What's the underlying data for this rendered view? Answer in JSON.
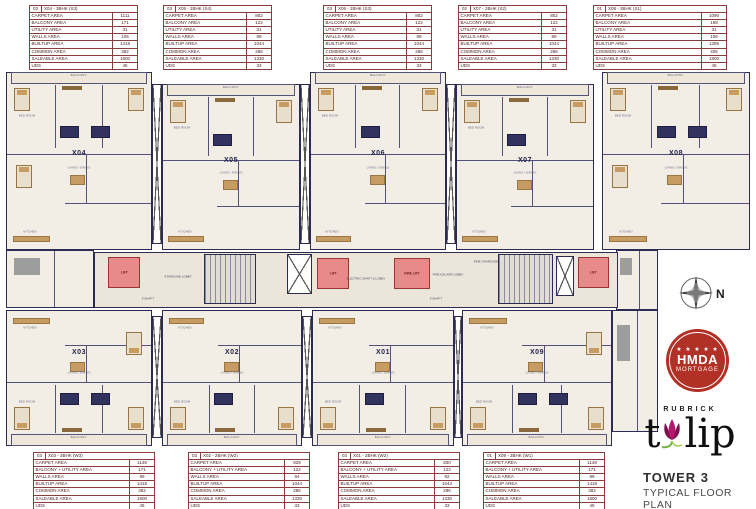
{
  "meta": {
    "tower_title": "TOWER 3",
    "subtitle": "TYPICAL FLOOR PLAN",
    "brand_top": "RUBRICK",
    "brand_word_left": "t",
    "brand_word_right": "lip",
    "badge_stars": "★ ★ ★ ★ ★",
    "badge_line1": "HMDA",
    "badge_line2": "MORTGAGE",
    "compass_n": "N"
  },
  "colors": {
    "wall": "#2c2c52",
    "cream": "#f2eee5",
    "corridor": "#ece6da",
    "tan": "#c69c62",
    "navy": "#32325e",
    "lift": "#e98a8a",
    "lift_border": "#9c3434",
    "table_border": "#8a3d3d",
    "table_text": "#4c2323"
  },
  "table_row_labels_top": [
    "CARPET AREA",
    "BALCONY AREA",
    "UTILITY AREA",
    "WALLS AREA",
    "BUILTUP AREA",
    "COMMON AREA",
    "SALEABLE AREA",
    "UDS"
  ],
  "table_row_labels_bottom": [
    "CARPET AREA",
    "BALCONY + UTILITY AREA",
    "WALLS AREA",
    "BUILTUP AREA",
    "COMMON AREA",
    "SALEABLE AREA",
    "UDS"
  ],
  "tables": {
    "top": [
      {
        "index": "03",
        "name": "X04 - 3BHK (S3)",
        "values": [
          "1111",
          "171",
          "31",
          "105",
          "1418",
          "382",
          "1800",
          "45"
        ],
        "x": 29,
        "w": 109
      },
      {
        "index": "03",
        "name": "X05 - 2BHK (S4)",
        "values": [
          "802",
          "122",
          "31",
          "89",
          "1044",
          "286",
          "1330",
          "33"
        ],
        "x": 163,
        "w": 109
      },
      {
        "index": "03",
        "name": "X06 - 2BHK (S3)",
        "values": [
          "802",
          "122",
          "31",
          "89",
          "1044",
          "286",
          "1330",
          "33"
        ],
        "x": 323,
        "w": 109
      },
      {
        "index": "02",
        "name": "X07 - 2BHK (S2)",
        "values": [
          "802",
          "122",
          "31",
          "89",
          "1044",
          "286",
          "1330",
          "33"
        ],
        "x": 458,
        "w": 109
      },
      {
        "index": "01",
        "name": "X08 - 3BHK (S1)",
        "values": [
          "1090",
          "168",
          "31",
          "106",
          "1395",
          "405",
          "1800",
          "45"
        ],
        "x": 593,
        "w": 134
      }
    ],
    "bottom": [
      {
        "index": "03",
        "name": "X03 - 3BHK (W3)",
        "values": [
          "1148",
          "171",
          "99",
          "1418",
          "382",
          "1800",
          "45"
        ],
        "x": 33,
        "w": 122
      },
      {
        "index": "03",
        "name": "X02 - 2BHK (W2)",
        "values": [
          "828",
          "122",
          "94",
          "1044",
          "286",
          "1330",
          "33"
        ],
        "x": 188,
        "w": 122
      },
      {
        "index": "03",
        "name": "X01 - 2BHK (W2)",
        "values": [
          "830",
          "122",
          "92",
          "1044",
          "286",
          "1330",
          "33"
        ],
        "x": 338,
        "w": 122
      },
      {
        "index": "01",
        "name": "X09 - 3BHK (W1)",
        "values": [
          "1148",
          "171",
          "99",
          "1418",
          "382",
          "1800",
          "45"
        ],
        "x": 483,
        "w": 122
      }
    ]
  },
  "plan": {
    "room_labels": {
      "balcony": "BALCONY",
      "living": "LIVING / DINING",
      "kitchen": "KITCHEN",
      "bed": "BED ROOM"
    },
    "units": [
      {
        "id": "X04",
        "row": "top",
        "bhk3": true,
        "x": 6,
        "y": 72,
        "w": 146,
        "h": 178
      },
      {
        "id": "X05",
        "row": "top",
        "bhk3": false,
        "x": 162,
        "y": 84,
        "w": 138,
        "h": 166
      },
      {
        "id": "X06",
        "row": "top",
        "bhk3": false,
        "x": 310,
        "y": 72,
        "w": 136,
        "h": 178
      },
      {
        "id": "X07",
        "row": "top",
        "bhk3": false,
        "x": 456,
        "y": 84,
        "w": 138,
        "h": 166
      },
      {
        "id": "X08",
        "row": "top",
        "bhk3": true,
        "x": 602,
        "y": 72,
        "w": 148,
        "h": 178
      },
      {
        "id": "X03",
        "row": "bottom",
        "bhk3": true,
        "x": 6,
        "y": 310,
        "w": 146,
        "h": 136
      },
      {
        "id": "X02",
        "row": "bottom",
        "bhk3": false,
        "x": 162,
        "y": 310,
        "w": 140,
        "h": 136
      },
      {
        "id": "X01",
        "row": "bottom",
        "bhk3": false,
        "x": 312,
        "y": 310,
        "w": 142,
        "h": 136
      },
      {
        "id": "X09",
        "row": "bottom",
        "bhk3": true,
        "x": 462,
        "y": 310,
        "w": 150,
        "h": 136
      }
    ],
    "extensions": [
      {
        "x": 6,
        "y": 250,
        "w": 88,
        "h": 58
      },
      {
        "x": 616,
        "y": 250,
        "w": 42,
        "h": 60
      },
      {
        "x": 612,
        "y": 310,
        "w": 46,
        "h": 122
      }
    ],
    "voids": [
      {
        "x": 152,
        "y": 84,
        "w": 10,
        "h": 160
      },
      {
        "x": 300,
        "y": 84,
        "w": 10,
        "h": 160
      },
      {
        "x": 446,
        "y": 84,
        "w": 10,
        "h": 160
      },
      {
        "x": 152,
        "y": 316,
        "w": 10,
        "h": 122
      },
      {
        "x": 302,
        "y": 316,
        "w": 10,
        "h": 122
      },
      {
        "x": 454,
        "y": 316,
        "w": 8,
        "h": 122
      }
    ],
    "corridor": {
      "x": 94,
      "y": 252,
      "w": 524,
      "h": 56
    },
    "lifts": [
      {
        "label": "LIFT",
        "x": 108,
        "y": 257,
        "w": 32,
        "h": 31
      },
      {
        "label": "LIFT",
        "x": 317,
        "y": 258,
        "w": 32,
        "h": 31
      },
      {
        "label": "FIRE LIFT",
        "x": 394,
        "y": 258,
        "w": 36,
        "h": 31
      },
      {
        "label": "LIFT",
        "x": 578,
        "y": 257,
        "w": 31,
        "h": 31
      }
    ],
    "stairs": [
      {
        "x": 204,
        "y": 254,
        "w": 52,
        "h": 50
      },
      {
        "x": 498,
        "y": 254,
        "w": 55,
        "h": 50
      }
    ],
    "shafts": [
      {
        "x": 287,
        "y": 254,
        "w": 25,
        "h": 40
      },
      {
        "x": 556,
        "y": 256,
        "w": 18,
        "h": 40
      }
    ],
    "corridor_labels": [
      {
        "text": "STAIRCASE LOBBY",
        "x": 178,
        "y": 278
      },
      {
        "text": "ELECTRIC SHAFT & LOBBY",
        "x": 366,
        "y": 280
      },
      {
        "text": "FIRE ESCAPE LOBBY",
        "x": 448,
        "y": 276
      },
      {
        "text": "FIRE STAIRCASE",
        "x": 486,
        "y": 263
      },
      {
        "text": "F.SHAFT",
        "x": 148,
        "y": 300
      },
      {
        "text": "F.SHAFT",
        "x": 436,
        "y": 300
      }
    ]
  }
}
